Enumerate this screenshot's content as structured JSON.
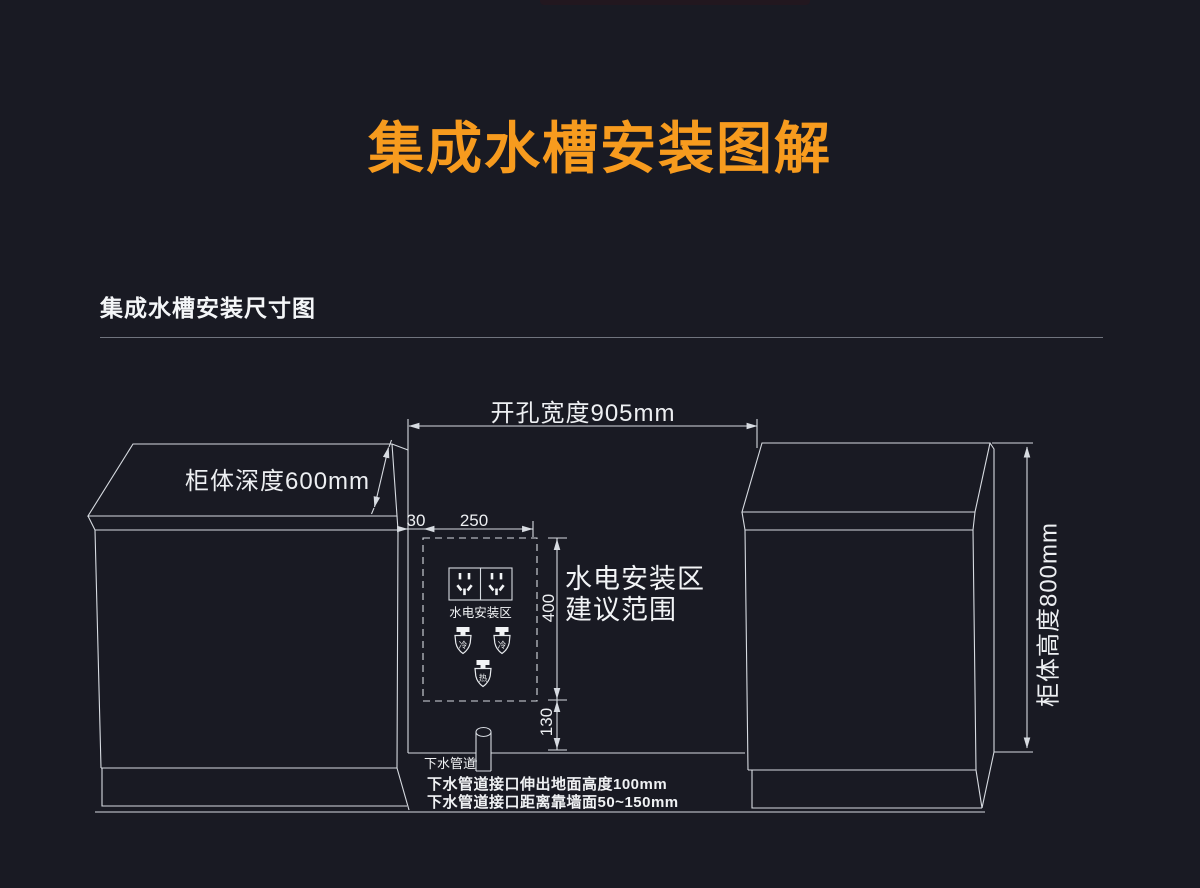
{
  "page": {
    "background_color": "#191A23",
    "accent_orange": "#F79B1E",
    "line_color": "#D7DBE1",
    "text_color": "#F3F5F7"
  },
  "title": "集成水槽安装图解",
  "section": {
    "heading": "集成水槽安装尺寸图"
  },
  "diagram": {
    "dimensions": {
      "opening_width": "开孔宽度905mm",
      "cabinet_depth": "柜体深度600mm",
      "cabinet_height": "柜体高度800mm",
      "offset_left": "30",
      "zone_width": "250",
      "zone_height": "400",
      "zone_bottom_offset": "130"
    },
    "labels": {
      "zone_box": "水电安装区",
      "zone_note_line1": "水电安装区",
      "zone_note_line2": "建议范围",
      "valve_cold": "冷",
      "valve_hot": "热",
      "drain_pipe": "下水管道",
      "drain_note1": "下水管道接口伸出地面高度100mm",
      "drain_note2": "下水管道接口距离靠墙面50~150mm"
    },
    "icons": {
      "socket": "power-outlet-icon",
      "cold_valve": "cold-water-valve-icon",
      "hot_valve": "hot-water-valve-icon",
      "drain": "drain-pipe-icon"
    }
  }
}
